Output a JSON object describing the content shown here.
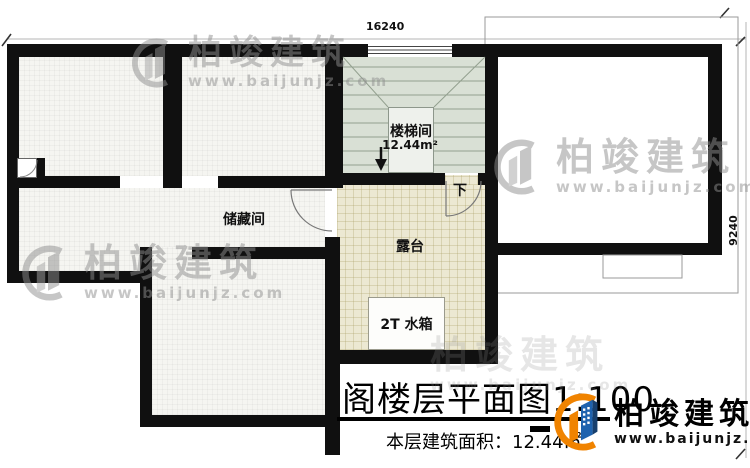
{
  "plan": {
    "dimensions": {
      "top": "16240",
      "right": "9240"
    },
    "rooms": {
      "stairwell": {
        "name": "楼梯间",
        "area": "12.44m²"
      },
      "storage": {
        "name": "储藏间"
      },
      "terrace": {
        "name": "露台"
      },
      "water_tank": {
        "name": "2T 水箱"
      },
      "stair_direction": {
        "label": "下"
      }
    },
    "title": {
      "text": "阁楼层平面图",
      "scale": "1:100",
      "area_label": "本层建筑面积：",
      "area_value": "12.44㎡"
    }
  },
  "brand": {
    "name": "柏竣建筑",
    "website": "www.baijunjz.com"
  },
  "watermark": {
    "name": "柏竣建筑",
    "website": "www.baijunjz.com"
  },
  "colors": {
    "wall": "#101010",
    "stairwell_fill": "#d9e0d5",
    "terrace_fill": "#ece8d2",
    "room_fill": "#f5f5f1",
    "brand_orange": "#f08300",
    "brand_blue": "#1e62ae"
  }
}
